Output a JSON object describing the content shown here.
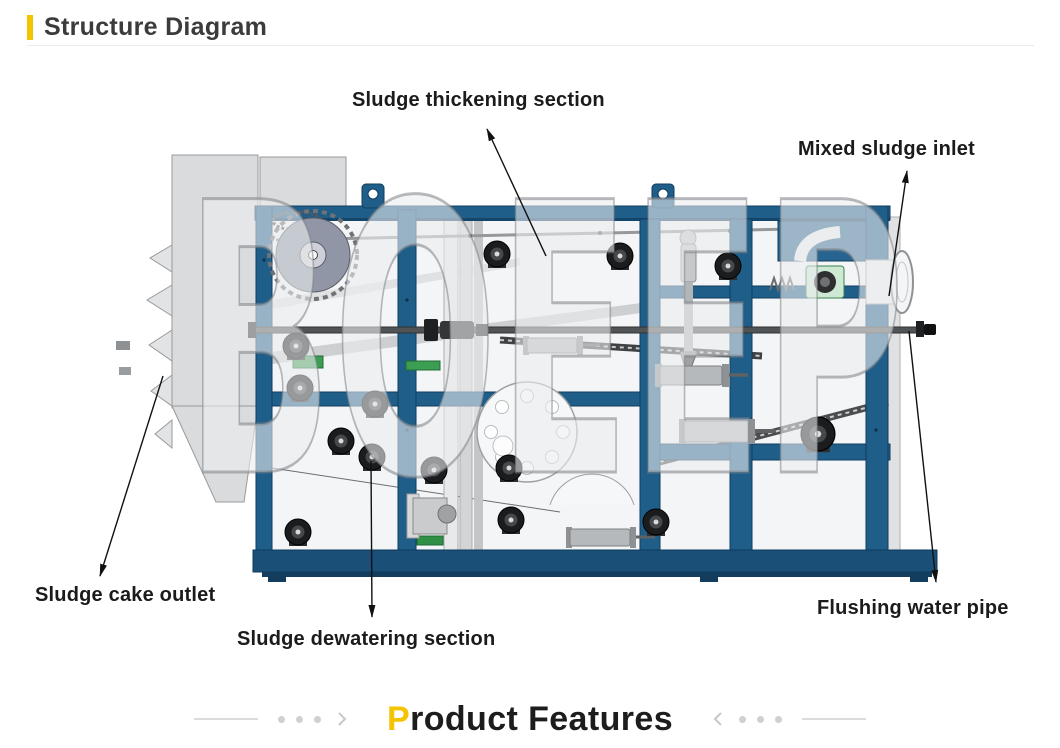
{
  "header": {
    "title": "Structure Diagram",
    "accent_color": "#F5C400",
    "text_color": "#3B3B3B"
  },
  "diagram": {
    "watermark": "BOEEP",
    "labels": [
      {
        "id": "thickening",
        "text": "Sludge thickening section"
      },
      {
        "id": "inlet",
        "text": "Mixed sludge inlet"
      },
      {
        "id": "cake-outlet",
        "text": "Sludge cake outlet"
      },
      {
        "id": "dewatering",
        "text": "Sludge dewatering section"
      },
      {
        "id": "flushing",
        "text": "Flushing water pipe"
      }
    ],
    "machine_colors": {
      "frame_blue": "#205E8A",
      "base_blue": "#1A4F78",
      "panel_gray": "#D9DBDC",
      "roller_black": "#1B1C1E",
      "accent_green": "#3B9E53",
      "arrow_black": "#111111"
    }
  },
  "footer": {
    "accent_letter": "P",
    "title_rest": "roduct Features",
    "accent_color": "#F5C400",
    "text_color": "#1D1D1D"
  }
}
